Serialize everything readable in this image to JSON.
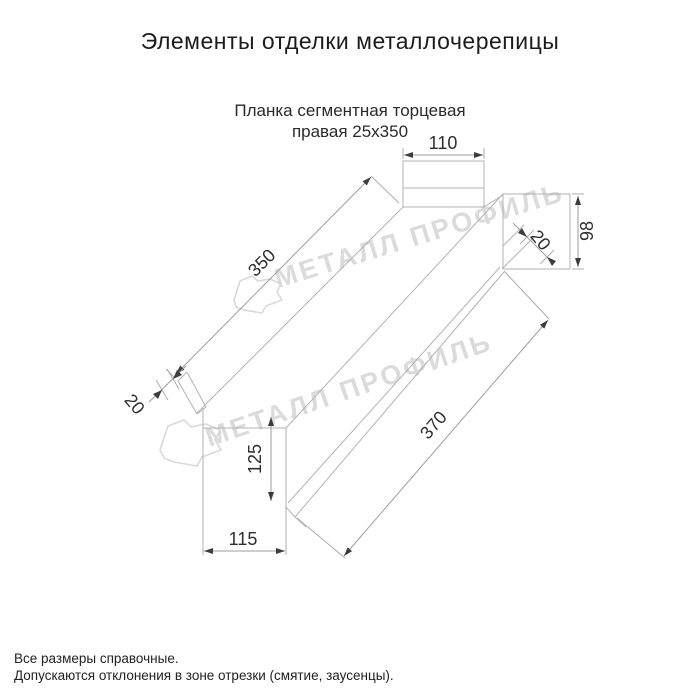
{
  "title": "Элементы отделки металлочерепицы",
  "subtitle": {
    "line1": "Планка сегментная торцевая",
    "line2": "правая 25х350"
  },
  "drawing": {
    "name": "Планка сегментная торцевая правая 25х350",
    "dimensions": {
      "top_width": "110",
      "right_height": "98",
      "right_hem": "20",
      "length_top": "350",
      "left_hem": "20",
      "bottom_height": "125",
      "bottom_width": "115",
      "length_bottom": "370"
    }
  },
  "watermark": {
    "text": "МЕТАЛЛ ПРОФИЛЬ"
  },
  "notes": {
    "line1": "Все размеры справочные.",
    "line2": "Допускаются отклонения в зоне отрезки (смятие, заусенцы)."
  },
  "colors": {
    "background": "#ffffff",
    "line_gray": "#b3b3b3",
    "dimension_text": "#2e2e2e",
    "watermark_gray": "#dbdbdb"
  }
}
